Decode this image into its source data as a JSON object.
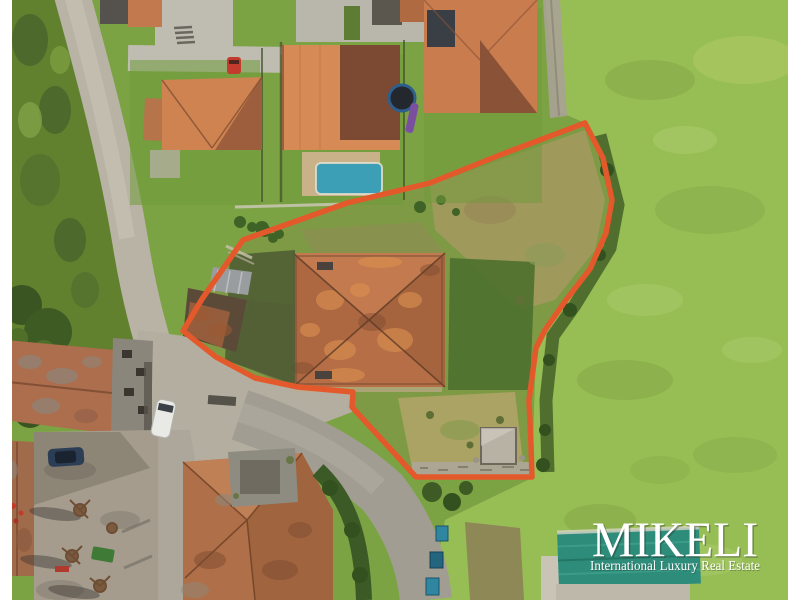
{
  "watermark": {
    "brand": "MIKELI",
    "tagline": "International Luxury Real Estate",
    "text_color": "#FFFFFF"
  },
  "photo": {
    "description": "Aerial drone view of a village plot with a large hip-roofed house, outlined by an orange property boundary, green fields to the right, modern houses with a pool at top, old stone village buildings and courtyard at bottom left",
    "boundary_color": "#E4592B",
    "frame_color": "#FFFFFF",
    "grass_color": "#7CA343",
    "bright_field_color": "#97BE55",
    "road_color": "#B6B1A3",
    "roof_terracotta_color": "#B56E46",
    "pool_color": "#3D9FB5",
    "warehouse_roof_color": "#2E8C7A",
    "van_color": "#E9E9E6",
    "red_car_color": "#C33B2C",
    "dark_car_color": "#2C3E55"
  }
}
